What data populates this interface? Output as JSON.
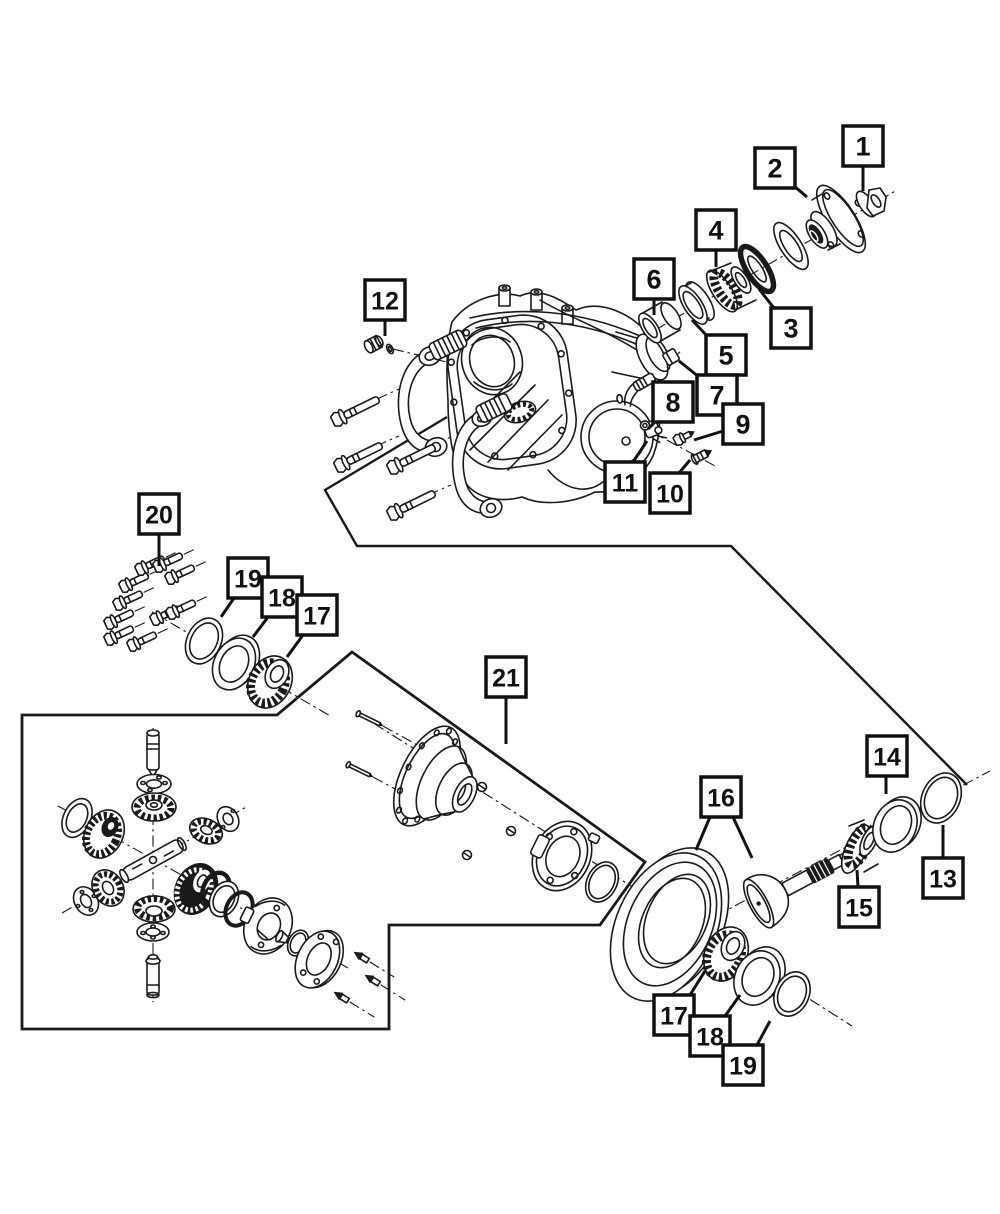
{
  "diagram": {
    "background_color": "#ffffff",
    "line_color": "#1a1a1a",
    "callout_style": {
      "box_size": 40,
      "border_width": 3.5,
      "font_size": 27,
      "leader_width": 3
    },
    "callouts": [
      {
        "id": "1",
        "label": "1",
        "x": 843,
        "y": 126,
        "leaders": [
          [
            [
              863,
              166
            ],
            [
              863,
              191
            ]
          ]
        ]
      },
      {
        "id": "2",
        "label": "2",
        "x": 755,
        "y": 148,
        "leaders": [
          [
            [
              794,
              186
            ],
            [
              807,
              197
            ]
          ]
        ]
      },
      {
        "id": "4",
        "label": "4",
        "x": 696,
        "y": 210,
        "leaders": [
          [
            [
              716,
              250
            ],
            [
              716,
              267
            ]
          ]
        ]
      },
      {
        "id": "6",
        "label": "6",
        "x": 634,
        "y": 259,
        "leaders": [
          [
            [
              654,
              299
            ],
            [
              654,
              315
            ]
          ]
        ]
      },
      {
        "id": "3",
        "label": "3",
        "x": 771,
        "y": 308,
        "leaders": [
          [
            [
              774,
              308
            ],
            [
              759,
              289
            ]
          ]
        ]
      },
      {
        "id": "5",
        "label": "5",
        "x": 706,
        "y": 335,
        "leaders": [
          [
            [
              708,
              337
            ],
            [
              692,
              320
            ]
          ]
        ]
      },
      {
        "id": "7",
        "label": "7",
        "x": 697,
        "y": 375,
        "leaders": [
          [
            [
              699,
              377
            ],
            [
              679,
              361
            ]
          ]
        ]
      },
      {
        "id": "8",
        "label": "8",
        "x": 653,
        "y": 382,
        "leaders": [
          [
            [
              656,
              421
            ],
            [
              648,
              429
            ]
          ]
        ]
      },
      {
        "id": "9",
        "label": "9",
        "x": 723,
        "y": 404,
        "leaders": [
          [
            [
              723,
              431
            ],
            [
              694,
              440
            ]
          ]
        ]
      },
      {
        "id": "11",
        "label": "11",
        "x": 605,
        "y": 462,
        "leaders": [
          [
            [
              633,
              462
            ],
            [
              647,
              441
            ]
          ]
        ]
      },
      {
        "id": "10",
        "label": "10",
        "x": 650,
        "y": 473,
        "leaders": [
          [
            [
              679,
              473
            ],
            [
              690,
              460
            ]
          ]
        ]
      },
      {
        "id": "12",
        "label": "12",
        "x": 365,
        "y": 280,
        "leaders": [
          [
            [
              385,
              320
            ],
            [
              385,
              336
            ]
          ]
        ]
      },
      {
        "id": "20",
        "label": "20",
        "x": 139,
        "y": 494,
        "leaders": [
          [
            [
              159,
              534
            ],
            [
              159,
              566
            ]
          ]
        ]
      },
      {
        "id": "19-left",
        "label": "19",
        "x": 228,
        "y": 558,
        "leaders": [
          [
            [
              234,
              598
            ],
            [
              221,
              617
            ]
          ]
        ]
      },
      {
        "id": "18-left",
        "label": "18",
        "x": 262,
        "y": 577,
        "leaders": [
          [
            [
              268,
              617
            ],
            [
              253,
              637
            ]
          ]
        ]
      },
      {
        "id": "17-left",
        "label": "17",
        "x": 297,
        "y": 595,
        "leaders": [
          [
            [
              303,
              635
            ],
            [
              287,
              657
            ]
          ]
        ]
      },
      {
        "id": "21",
        "label": "21",
        "x": 486,
        "y": 657,
        "leaders": [
          [
            [
              506,
              697
            ],
            [
              506,
              744
            ]
          ]
        ]
      },
      {
        "id": "16",
        "label": "16",
        "x": 701,
        "y": 777,
        "leaders": [
          [
            [
              710,
              817
            ],
            [
              696,
              850
            ]
          ],
          [
            [
              733,
              817
            ],
            [
              752,
              858
            ]
          ]
        ]
      },
      {
        "id": "14",
        "label": "14",
        "x": 867,
        "y": 736,
        "leaders": [
          [
            [
              886,
              776
            ],
            [
              886,
              794
            ]
          ]
        ]
      },
      {
        "id": "13",
        "label": "13",
        "x": 923,
        "y": 858,
        "leaders": [
          [
            [
              943,
              858
            ],
            [
              943,
              825
            ]
          ]
        ]
      },
      {
        "id": "15",
        "label": "15",
        "x": 839,
        "y": 887,
        "leaders": [
          [
            [
              858,
              887
            ],
            [
              857,
              870
            ]
          ]
        ]
      },
      {
        "id": "17-bottom",
        "label": "17",
        "x": 654,
        "y": 995,
        "leaders": [
          [
            [
              690,
              995
            ],
            [
              705,
              971
            ]
          ]
        ]
      },
      {
        "id": "18-bottom",
        "label": "18",
        "x": 690,
        "y": 1016,
        "leaders": [
          [
            [
              725,
              1016
            ],
            [
              740,
              995
            ]
          ]
        ]
      },
      {
        "id": "19-bottom",
        "label": "19",
        "x": 723,
        "y": 1045,
        "leaders": [
          [
            [
              757,
              1045
            ],
            [
              770,
              1021
            ]
          ]
        ]
      }
    ]
  }
}
